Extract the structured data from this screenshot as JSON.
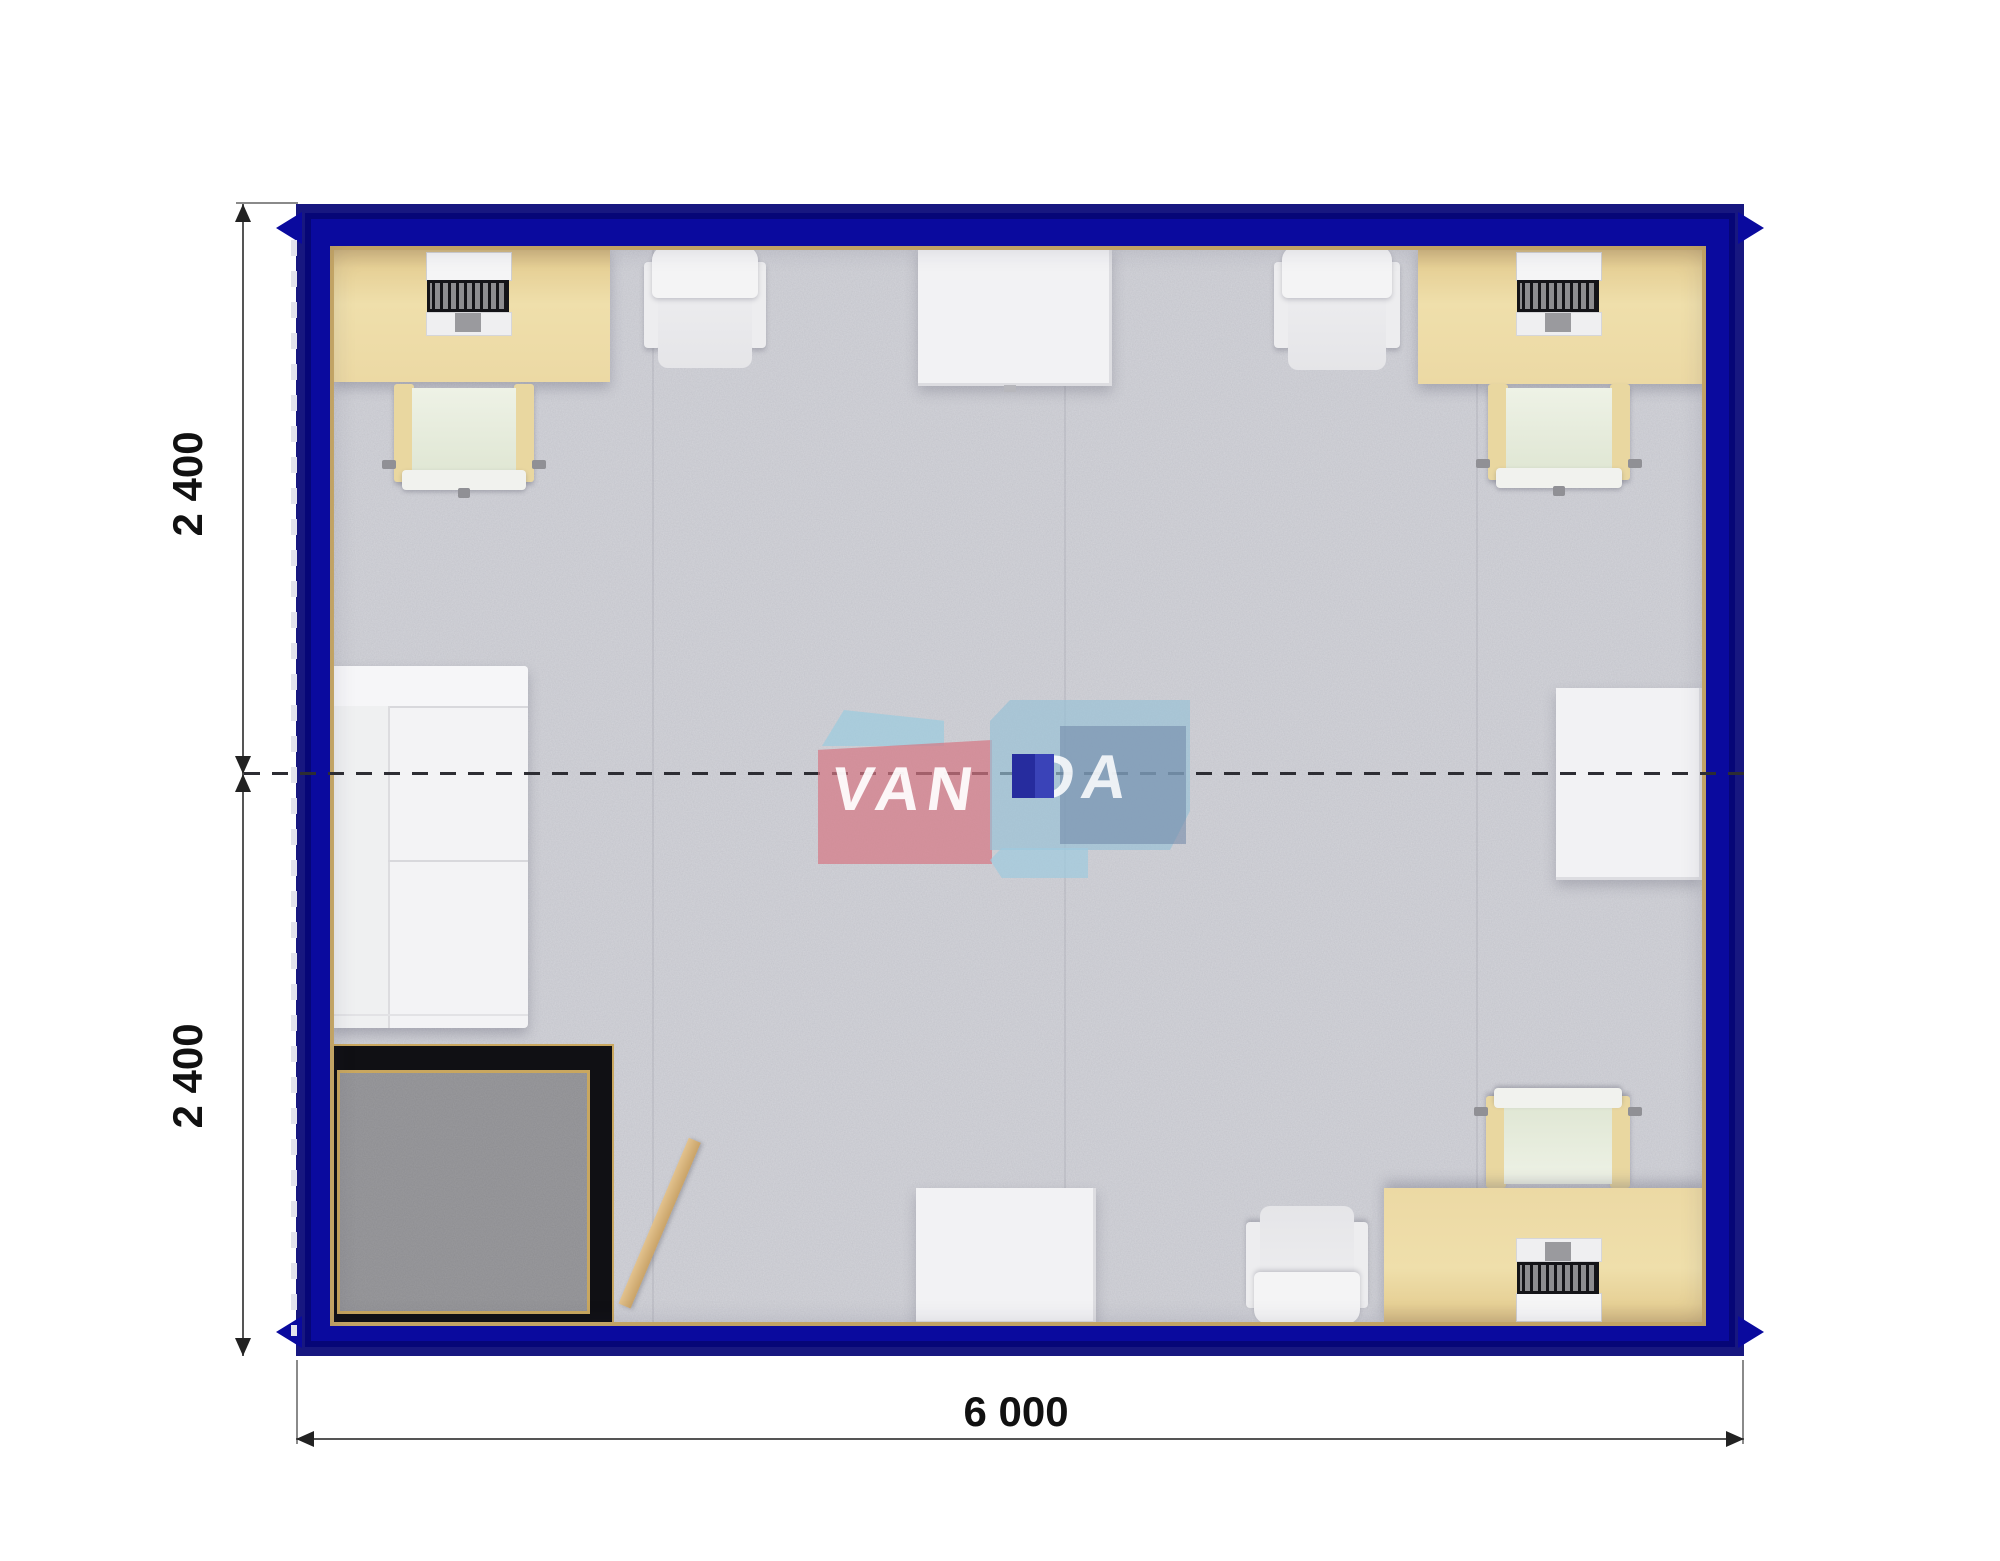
{
  "plan": {
    "brand": "VANDA",
    "watermark": {
      "left_text": "VAN",
      "right_text": "DA"
    },
    "dimensions": {
      "left_top": "2 400",
      "left_bottom": "2 400",
      "bottom_width": "6 000"
    },
    "colors": {
      "frame_blue": "#0a0a9e",
      "frame_blue_dark": "#05055c",
      "carpet_gray": "#cbccd2",
      "vestibule_carpet_gray": "#9b9b9e",
      "vestibule_wall_black": "#101014",
      "trim_gold": "#c9a75f",
      "desk_beige": "#ecd9a4",
      "furniture_white": "#f2f2f4",
      "chair_seat_green": "#e3e9d8",
      "door_tan": "#d4b27a",
      "logo_pink": "#d67683",
      "logo_light_blue": "#9ecbde",
      "logo_navy": "#262c9e",
      "dimension_text": "#111111"
    }
  }
}
